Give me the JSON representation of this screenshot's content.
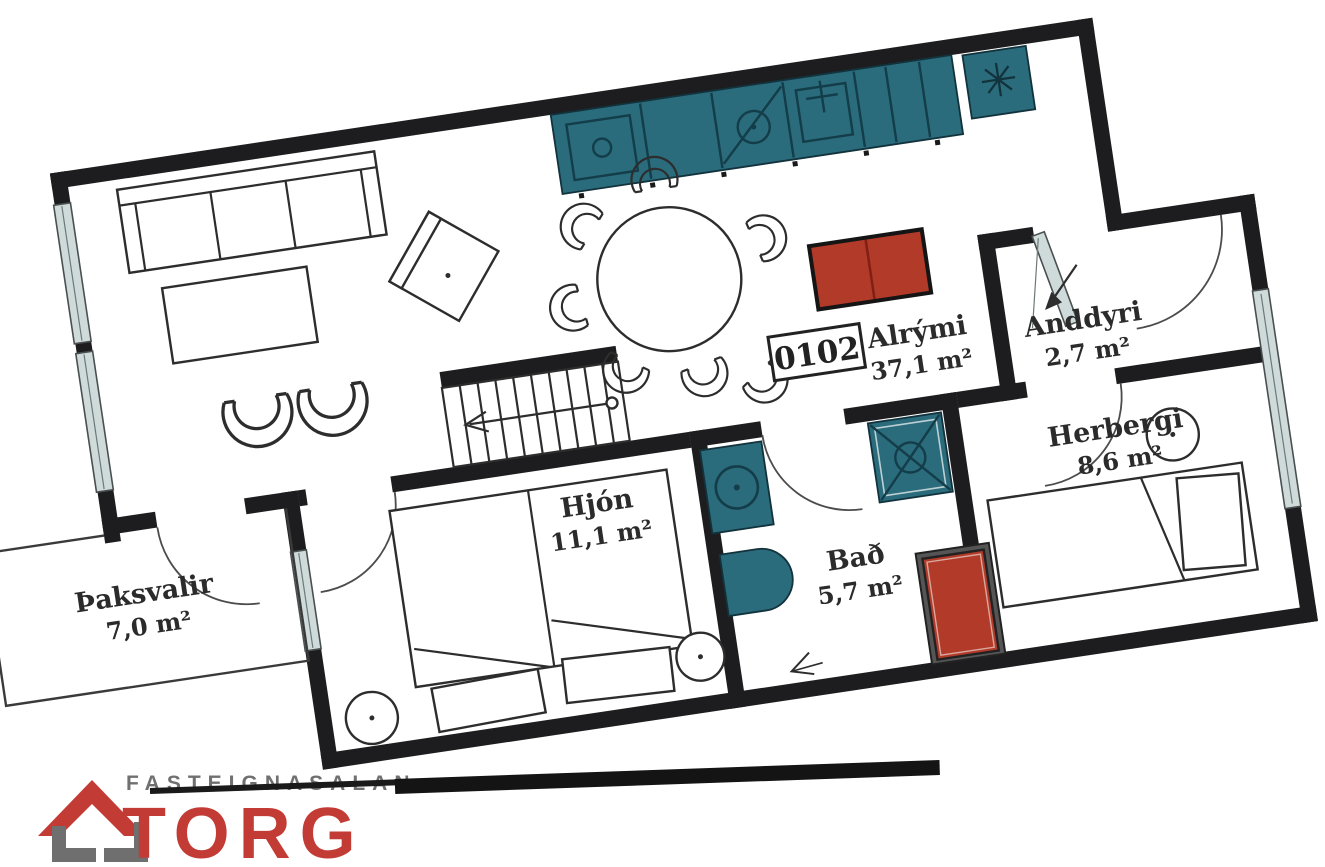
{
  "plan": {
    "unit_number": "0102",
    "rooms": [
      {
        "name": "Alrými",
        "area": "37,1 m²"
      },
      {
        "name": "Anddyri",
        "area": "2,7 m²"
      },
      {
        "name": "Hjón",
        "area": "11,1 m²"
      },
      {
        "name": "Bað",
        "area": "5,7 m²"
      },
      {
        "name": "Herbergi",
        "area": "8,6 m²"
      },
      {
        "name": "Þaksvalir",
        "area": "7,0 m²"
      }
    ],
    "colors": {
      "wall": "#1d1d1f",
      "fixture_teal": "#2a6b7c",
      "accent_red": "#b23a28",
      "window_glass": "#cfdbdb"
    }
  },
  "logo": {
    "company": "FASTEIGNASALAN",
    "brand": "TORG",
    "brand_color": "#c23b34",
    "company_color": "#707070"
  }
}
